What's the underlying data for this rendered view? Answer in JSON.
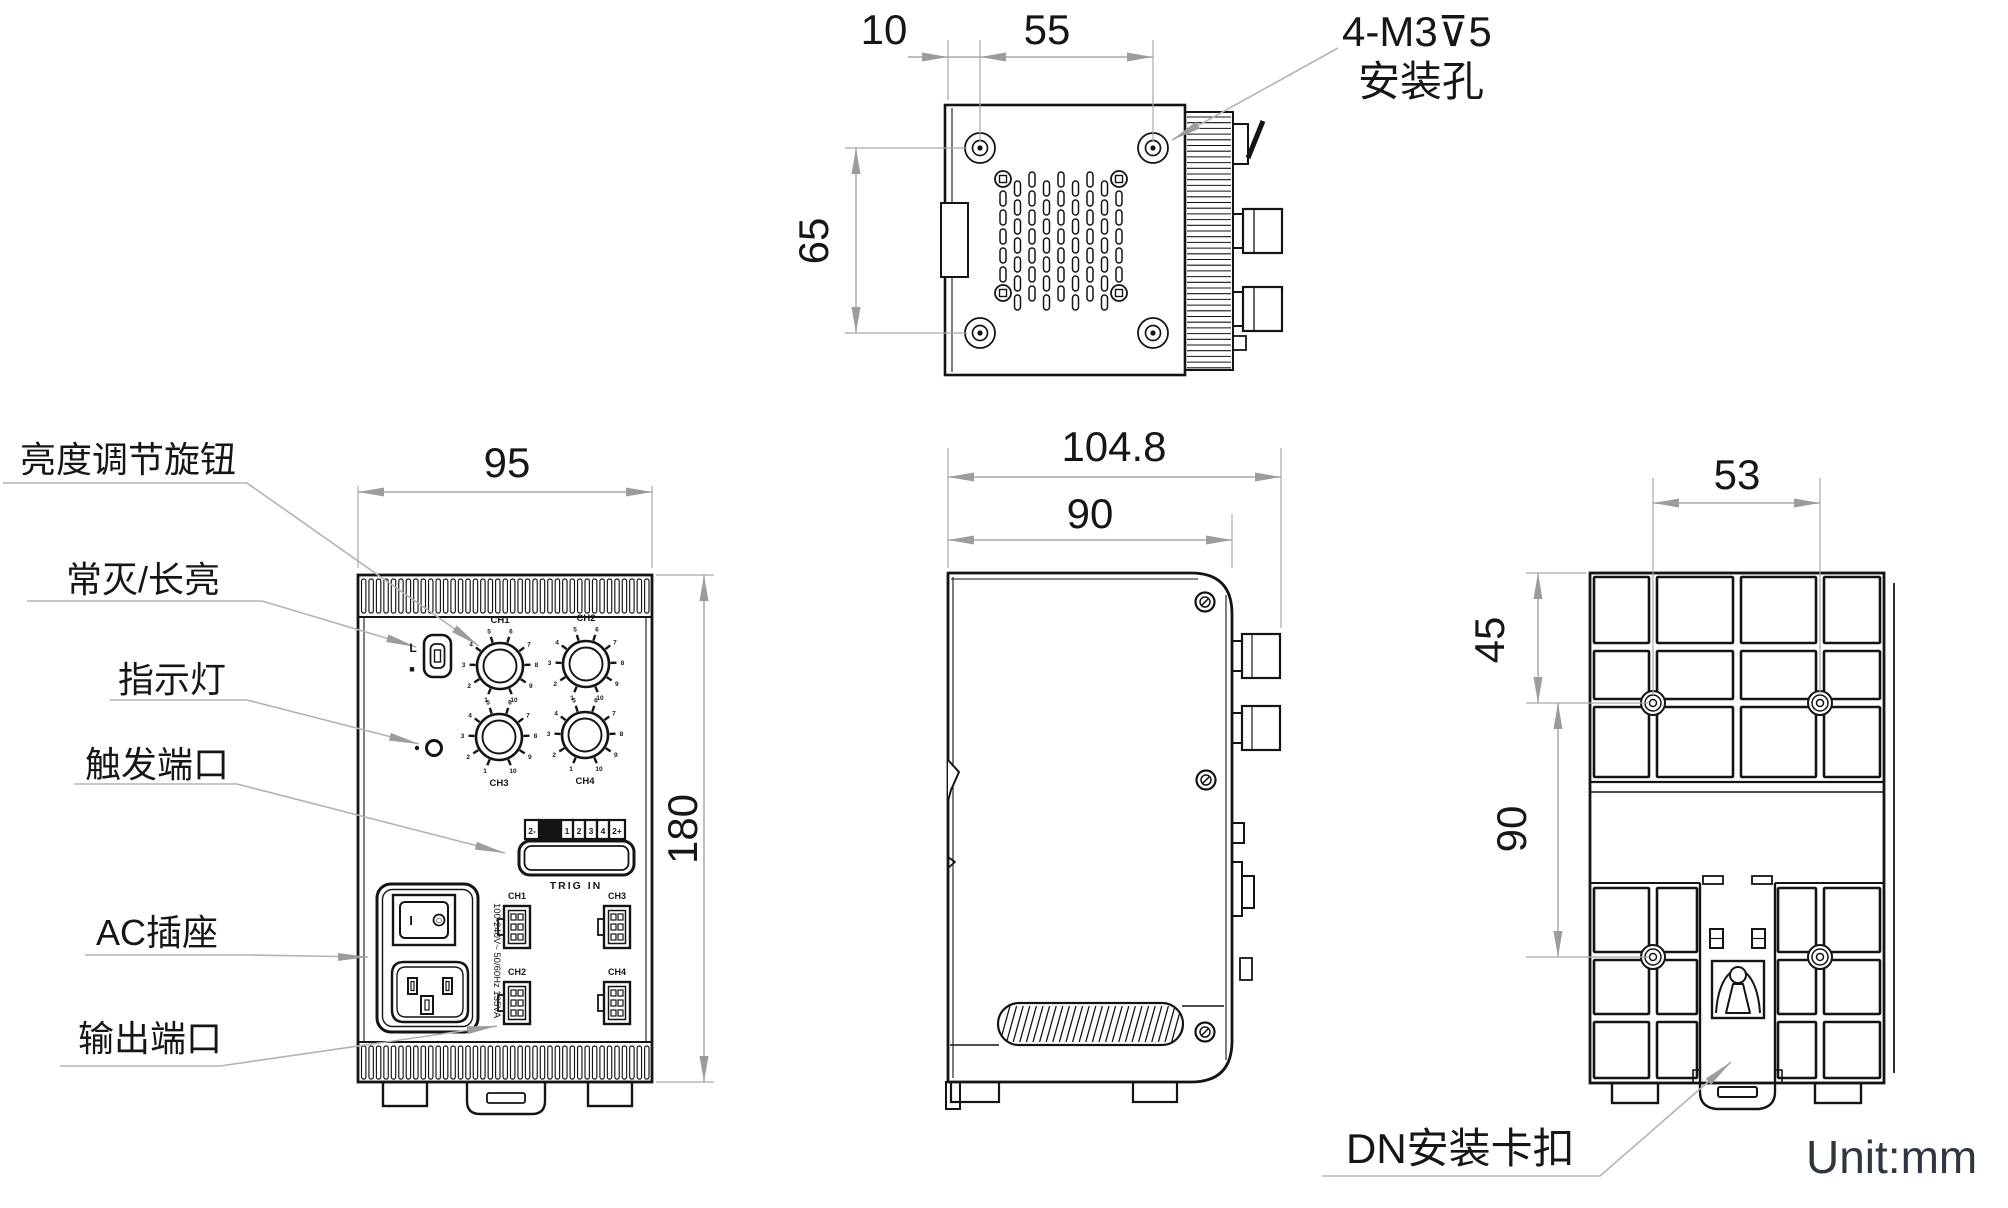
{
  "unit_label": "Unit:mm",
  "top_view": {
    "dim_edge_to_hole": "10",
    "dim_hole_spacing_horizontal": "55",
    "dim_hole_spacing_vertical": "65",
    "mounting_callout_line1": "4-M3⊽5",
    "mounting_callout_line2": "安装孔"
  },
  "front_view": {
    "dim_width": "95",
    "dim_height": "180",
    "callout_brightness_knob": "亮度调节旋钮",
    "callout_mode_switch": "常灭/长亮",
    "callout_indicator": "指示灯",
    "callout_trigger_port": "触发端口",
    "callout_ac_socket": "AC插座",
    "callout_output_port": "输出端口",
    "mode_switch_top_label": "L",
    "mode_switch_bottom_label": "■",
    "knob_labels": [
      "CH1",
      "CH2",
      "CH3",
      "CH4"
    ],
    "knob_scale_ticks": [
      "1",
      "2",
      "3",
      "4",
      "5",
      "6",
      "7",
      "8",
      "9",
      "10"
    ],
    "trigger_terminal_cells": [
      "2-",
      "COM",
      "1",
      "2",
      "3",
      "4",
      "2+"
    ],
    "trigger_port_label": "TRIG IN",
    "output_connector_labels": [
      "CH1",
      "CH3",
      "CH2",
      "CH4"
    ],
    "power_switch_on_mark": "I",
    "power_switch_off_mark": "○",
    "power_rating_text": "100-240V~ 50/60Hz 135VA"
  },
  "side_view": {
    "dim_depth_overall": "104.8",
    "dim_depth_body": "90"
  },
  "back_view": {
    "dim_hole_spacing_horizontal": "53",
    "dim_top_to_hole": "45",
    "dim_hole_spacing_vertical": "90",
    "callout_din_clip": "DN安装卡扣"
  }
}
